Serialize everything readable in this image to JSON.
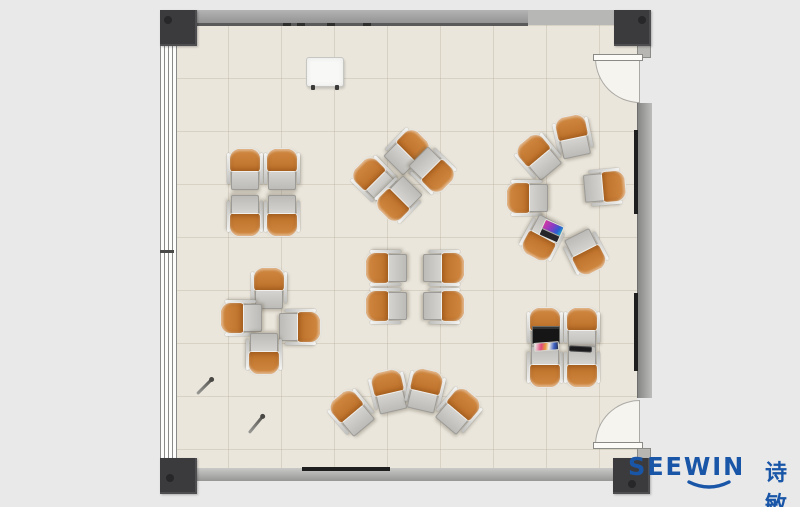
{
  "branding": {
    "logo_latin": "SEEWIN",
    "logo_cn": "诗敏"
  },
  "palette": {
    "outside": "#E9E9E9",
    "floor": "#EAE6DC",
    "grid_line": "rgba(150,140,115,0.22)",
    "wall": "#9E9E9E",
    "column": "#3B3B3D",
    "chair": "#C5772F",
    "desk": "#C9C8C3",
    "board_dark": "#1E1E1E",
    "logo_blue": "#1A56A8"
  },
  "room": {
    "label": "training-room-floor-plan",
    "doors": [
      "top-right",
      "bottom-right"
    ],
    "window_side": "left",
    "columns": 4
  },
  "furniture": {
    "unit_type": "tablet-arm-chair",
    "clusters": [
      {
        "id": "quad-top-left",
        "units": [
          [
            245,
            169,
            0
          ],
          [
            282,
            169,
            0
          ],
          [
            245,
            216,
            180
          ],
          [
            282,
            216,
            180
          ]
        ]
      },
      {
        "id": "pinwheel-top-center",
        "units": [
          [
            408,
            151,
            45
          ],
          [
            374,
            179,
            -45
          ],
          [
            398,
            200,
            -135
          ],
          [
            433,
            171,
            135
          ]
        ]
      },
      {
        "id": "circle-right",
        "units": [
          [
            573,
            136,
            -12
          ],
          [
            538,
            156,
            -40
          ],
          [
            527,
            198,
            -90
          ],
          [
            605,
            187,
            85
          ],
          [
            542,
            239,
            -152
          ],
          [
            586,
            253,
            153
          ]
        ]
      },
      {
        "id": "pinwheel-left",
        "units": [
          [
            269,
            288,
            0
          ],
          [
            241,
            318,
            -90
          ],
          [
            300,
            327,
            90
          ],
          [
            264,
            354,
            180
          ]
        ]
      },
      {
        "id": "quad-center",
        "units": [
          [
            386,
            268,
            -90
          ],
          [
            386,
            306,
            -90
          ],
          [
            444,
            268,
            90
          ],
          [
            444,
            306,
            90
          ]
        ]
      },
      {
        "id": "fan-bottom",
        "units": [
          [
            351,
            412,
            -40
          ],
          [
            389,
            391,
            -13
          ],
          [
            425,
            390,
            13
          ],
          [
            459,
            410,
            40
          ]
        ]
      },
      {
        "id": "quad-bottom-right",
        "units": [
          [
            545,
            328,
            0
          ],
          [
            582,
            328,
            0
          ],
          [
            545,
            367,
            180
          ],
          [
            582,
            367,
            180
          ]
        ]
      }
    ],
    "accessories": [
      {
        "type": "flipchart",
        "x": 306,
        "y": 57,
        "w": 38,
        "h": 30,
        "r": 0
      },
      {
        "type": "laptop-open",
        "x": 541,
        "y": 222,
        "w": 21,
        "h": 18,
        "r": 24
      },
      {
        "type": "laptop-black",
        "x": 532,
        "y": 326,
        "w": 28,
        "h": 18,
        "r": 0
      },
      {
        "type": "papers",
        "x": 534,
        "y": 342,
        "w": 25,
        "h": 9,
        "r": -4
      },
      {
        "type": "tablet",
        "x": 569,
        "y": 346,
        "w": 23,
        "h": 6,
        "r": 3
      },
      {
        "type": "pen",
        "x1": 197,
        "y1": 392,
        "x2": 212,
        "y2": 377
      },
      {
        "type": "pen",
        "x1": 249,
        "y1": 431,
        "x2": 263,
        "y2": 414
      }
    ]
  },
  "wall_items": [
    {
      "type": "board-v",
      "x": 634,
      "y": 130,
      "w": 4,
      "h": 84
    },
    {
      "type": "board-v",
      "x": 634,
      "y": 293,
      "w": 4,
      "h": 78
    },
    {
      "type": "board-h",
      "x": 302,
      "y": 467,
      "w": 88,
      "h": 4
    },
    {
      "type": "mark",
      "x": 283,
      "y": 23,
      "w": 8,
      "h": 3
    },
    {
      "type": "mark",
      "x": 297,
      "y": 23,
      "w": 8,
      "h": 3
    },
    {
      "type": "mark",
      "x": 327,
      "y": 23,
      "w": 8,
      "h": 3
    },
    {
      "type": "mark",
      "x": 363,
      "y": 23,
      "w": 8,
      "h": 3
    }
  ]
}
